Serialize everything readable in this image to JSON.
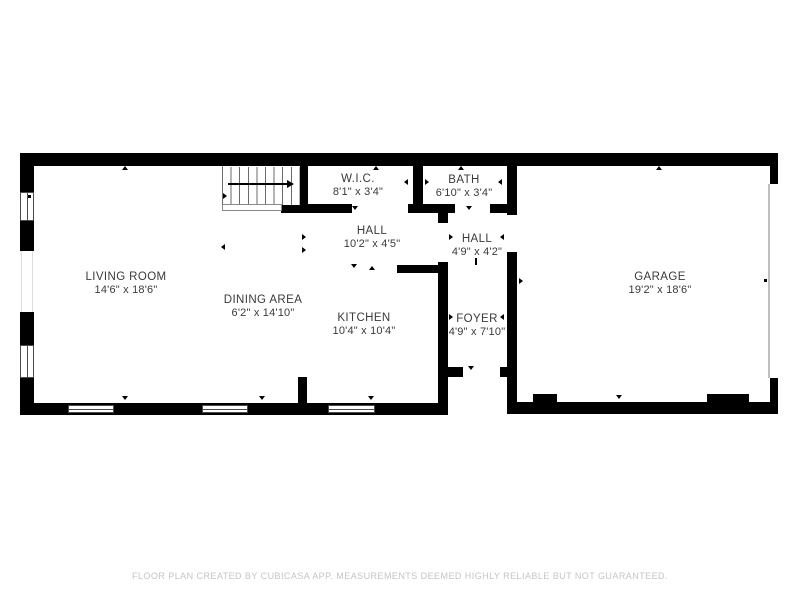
{
  "rooms": [
    {
      "id": "living-room",
      "name": "LIVING ROOM",
      "dimensions": "14'6\" x 18'6\""
    },
    {
      "id": "dining-area",
      "name": "DINING AREA",
      "dimensions": "6'2\" x 14'10\""
    },
    {
      "id": "kitchen",
      "name": "KITCHEN",
      "dimensions": "10'4\" x 10'4\""
    },
    {
      "id": "wic",
      "name": "W.I.C.",
      "dimensions": "8'1\" x 3'4\""
    },
    {
      "id": "bath",
      "name": "BATH",
      "dimensions": "6'10\" x 3'4\""
    },
    {
      "id": "hall-upper",
      "name": "HALL",
      "dimensions": "10'2\" x 4'5\""
    },
    {
      "id": "hall-lower",
      "name": "HALL",
      "dimensions": "4'9\" x 4'2\""
    },
    {
      "id": "foyer",
      "name": "FOYER",
      "dimensions": "4'9\" x 7'10\""
    },
    {
      "id": "garage",
      "name": "GARAGE",
      "dimensions": "19'2\" x 18'6\""
    }
  ],
  "footer": {
    "disclaimer": "FLOOR PLAN CREATED BY CUBICASA APP. MEASUREMENTS DEEMED HIGHLY RELIABLE BUT NOT GUARANTEED."
  },
  "colors": {
    "wall": "#000000",
    "label_text": "#3a3a3a",
    "footer_text": "#c4c4c8",
    "background": "#ffffff",
    "window_outline": "#4a4a4a"
  }
}
